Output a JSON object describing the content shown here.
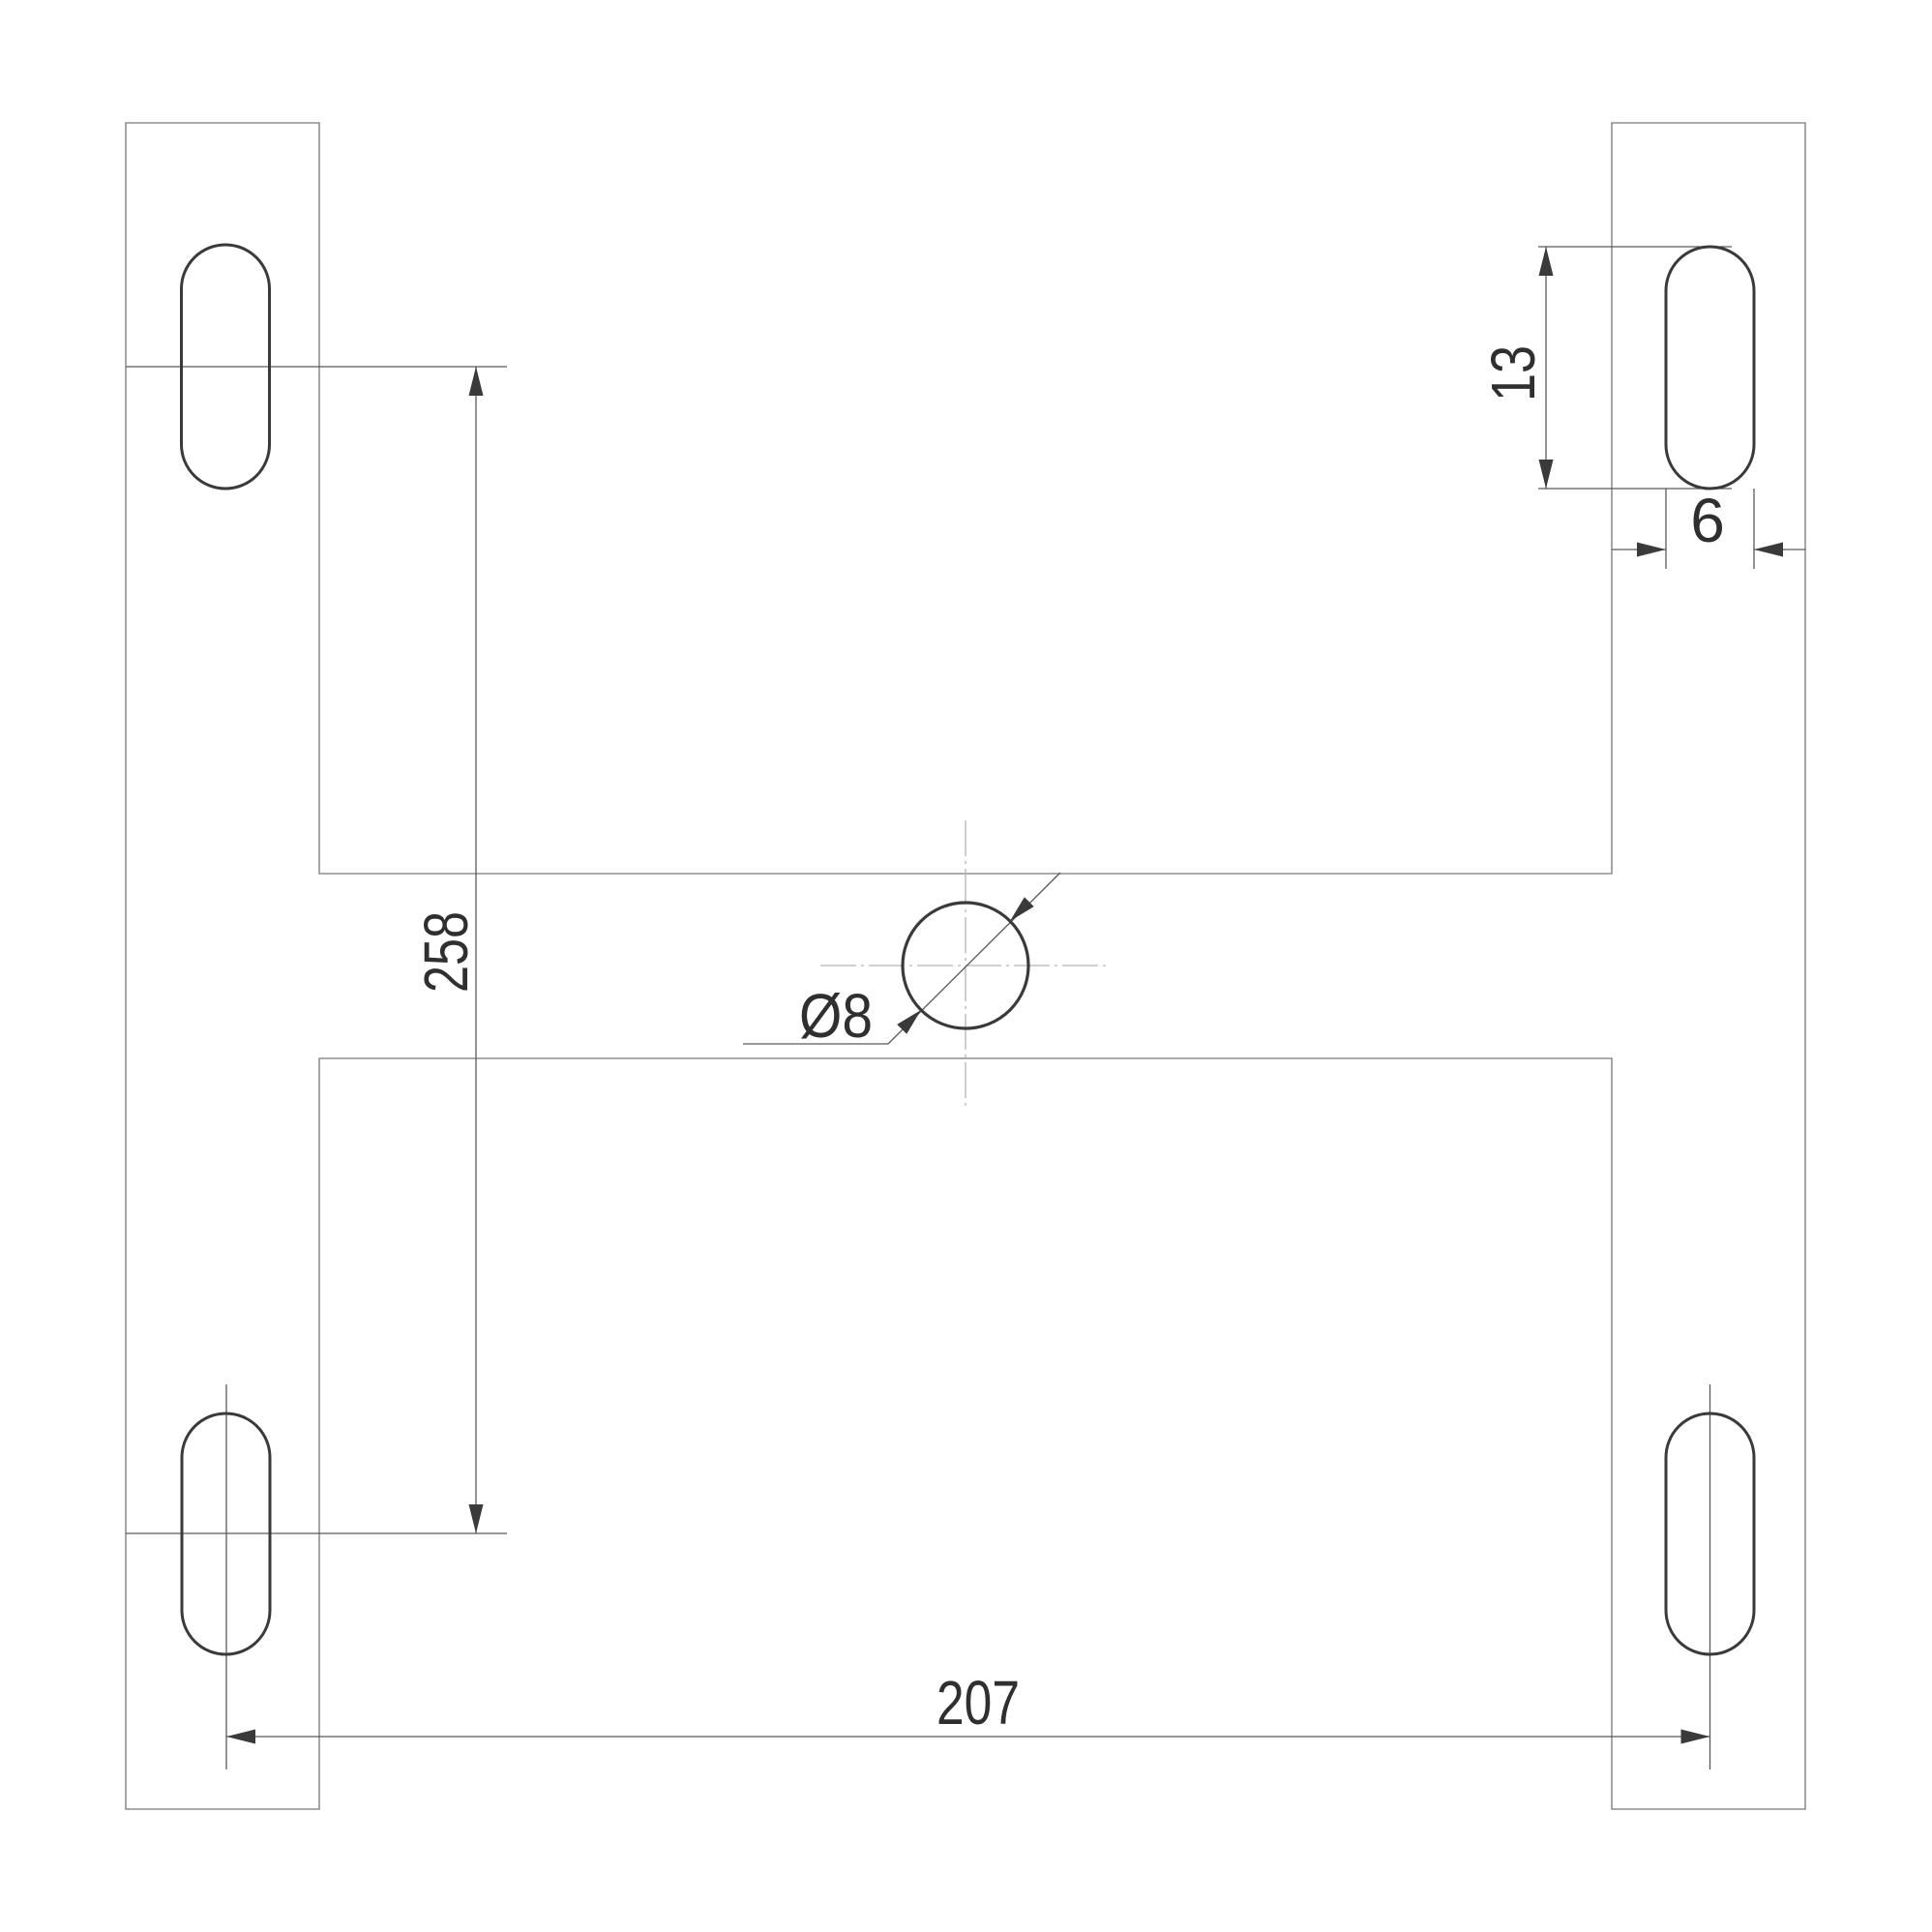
{
  "drawing": {
    "dimensions": {
      "vertical_slot_spacing": "258",
      "horizontal_slot_spacing": "207",
      "slot_length": "13",
      "slot_width": "6",
      "center_hole_diameter": "Ø8"
    },
    "colors": {
      "background": "#ffffff",
      "object_stroke": "#3a3a3a",
      "outline_stroke": "#8f8f8f",
      "dimension_stroke": "#5a5a5a",
      "centerline_stroke": "#b3b3b3",
      "text": "#2f2f2f"
    }
  }
}
